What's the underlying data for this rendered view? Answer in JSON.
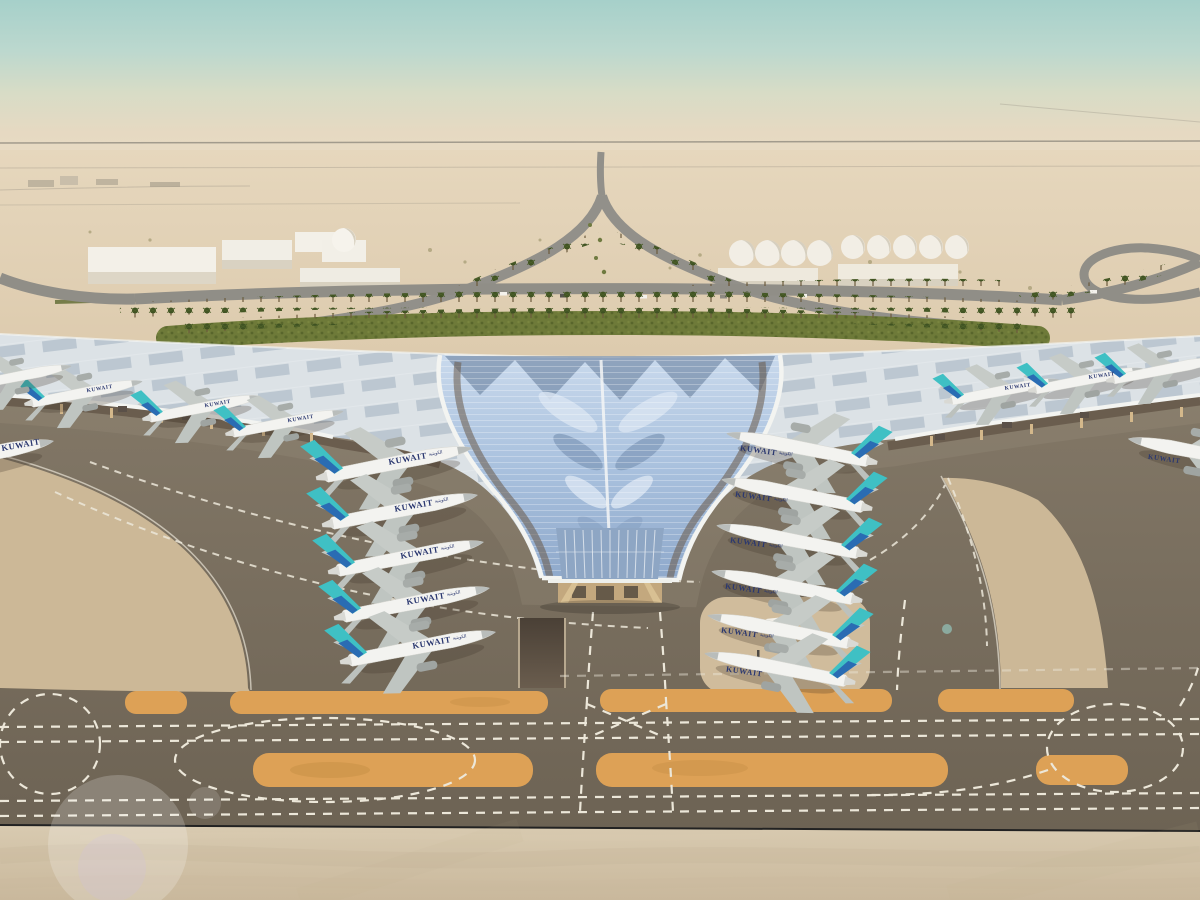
{
  "aircraft": {
    "label": "KUWAIT",
    "arabic_label": "الكويتية",
    "visible_count": 16
  },
  "colors": {
    "sky_top": "#a6d0ca",
    "sky_horizon": "#e6d9c2",
    "desert_far": "#e6d7bd",
    "desert_near": "#d2bd9d",
    "road_gray": "#92908a",
    "hedge_green": "#6e7a39",
    "palm_green": "#3f5222",
    "roof_silver": "#dce2e6",
    "roof_glass": "#a9c1de",
    "roof_fascia": "#f3f4f1",
    "terminal_underside": "#635547",
    "column_tan": "#d4b88b",
    "apron": "#7b7163",
    "sand": "#ccb897",
    "sand_island": "#d0bc9c",
    "marking_orange": "#dda156",
    "marking_white": "#ece7d9",
    "concrete_bottom": "#d4c5ab",
    "fuselage_white": "#f3f3f0",
    "tail_teal": "#3fc0c4",
    "tail_blue": "#2a6cb3",
    "titles_navy": "#2b3870"
  }
}
